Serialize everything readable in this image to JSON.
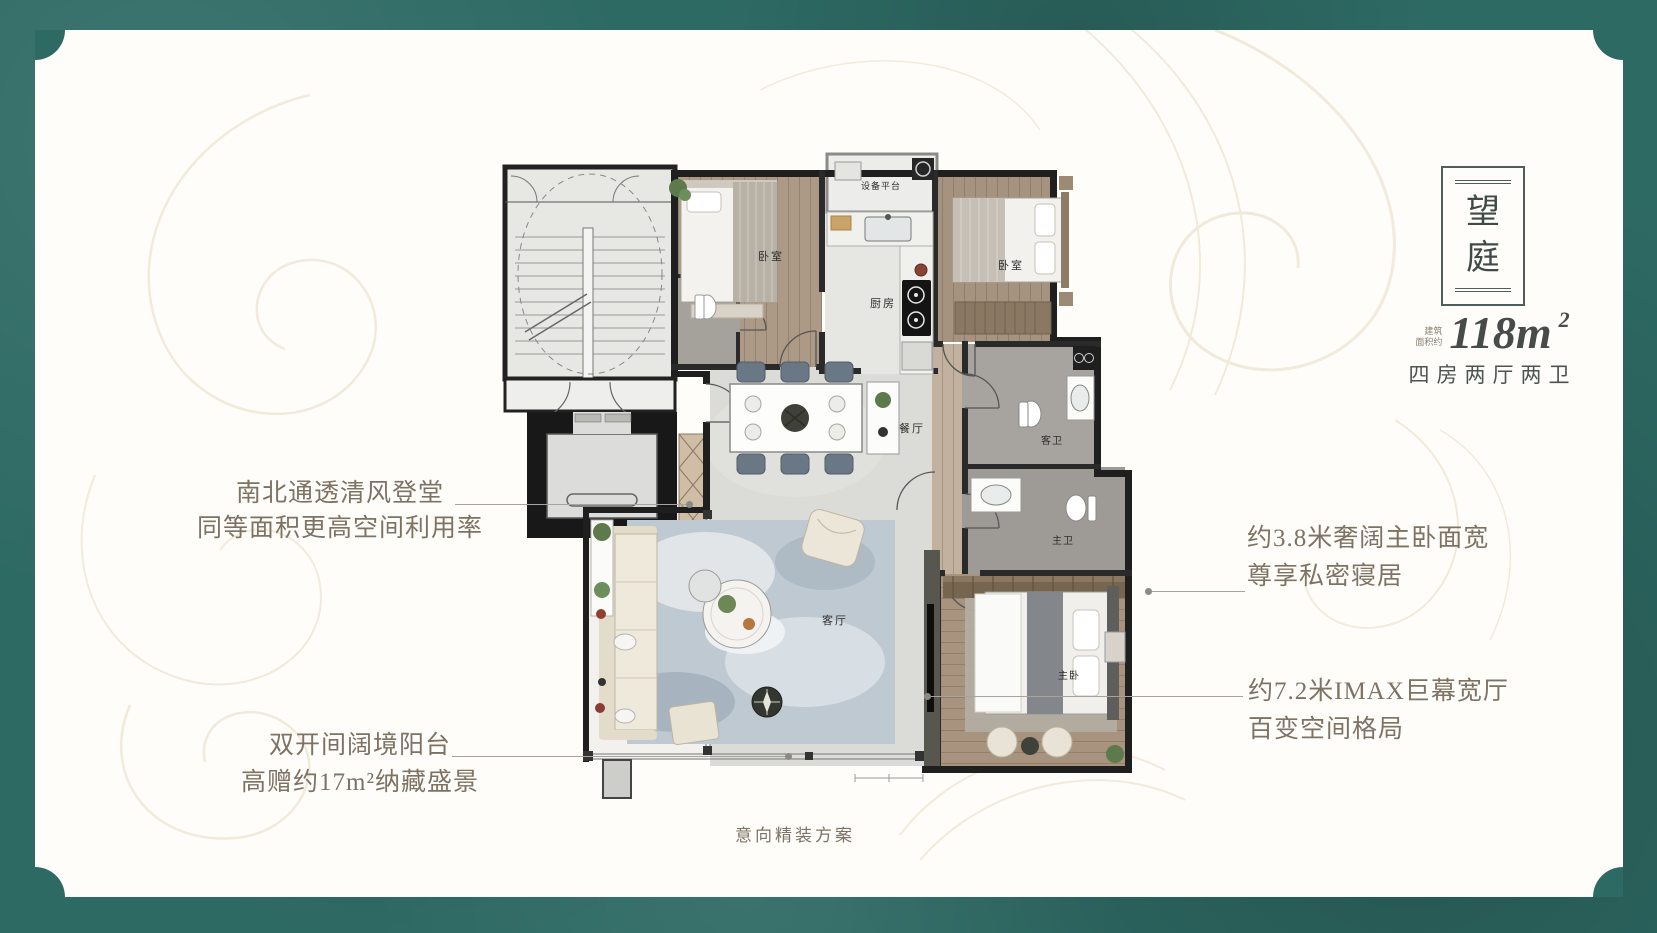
{
  "plaque": {
    "char_top": "望",
    "char_bottom": "庭"
  },
  "specs": {
    "area_prefix_line1": "建筑",
    "area_prefix_line2": "面积约",
    "area_number": "118m",
    "area_sup": "2",
    "layout_text": "四房两厅两卫"
  },
  "annotations": {
    "left_top": {
      "line1": "南北通透清风登堂",
      "line2": "同等面积更高空间利用率"
    },
    "left_bottom": {
      "line1": "双开间阔境阳台",
      "line2": "高赠约17m²纳藏盛景"
    },
    "right_top": {
      "line1": "约3.8米奢阔主卧面宽",
      "line2": "尊享私密寝居"
    },
    "right_bottom": {
      "line1": "约7.2米IMAX巨幕宽厅",
      "line2": "百变空间格局"
    }
  },
  "caption": "意向精装方案",
  "plan": {
    "rooms": {
      "equipment_platform": "设备平台",
      "bedroom_a": "卧室",
      "kitchen": "厨房",
      "bedroom_b": "卧室",
      "dining": "餐厅",
      "guest_bath": "客卫",
      "master_bath": "主卫",
      "living": "客厅",
      "master_bedroom": "主卧"
    }
  },
  "colors": {
    "frame_teal": "#2e6a64",
    "swirl_beige": "#e9dfc8",
    "annotation_text": "#7d7263",
    "title_text": "#46524e",
    "wall_black": "#1f1f1f"
  }
}
